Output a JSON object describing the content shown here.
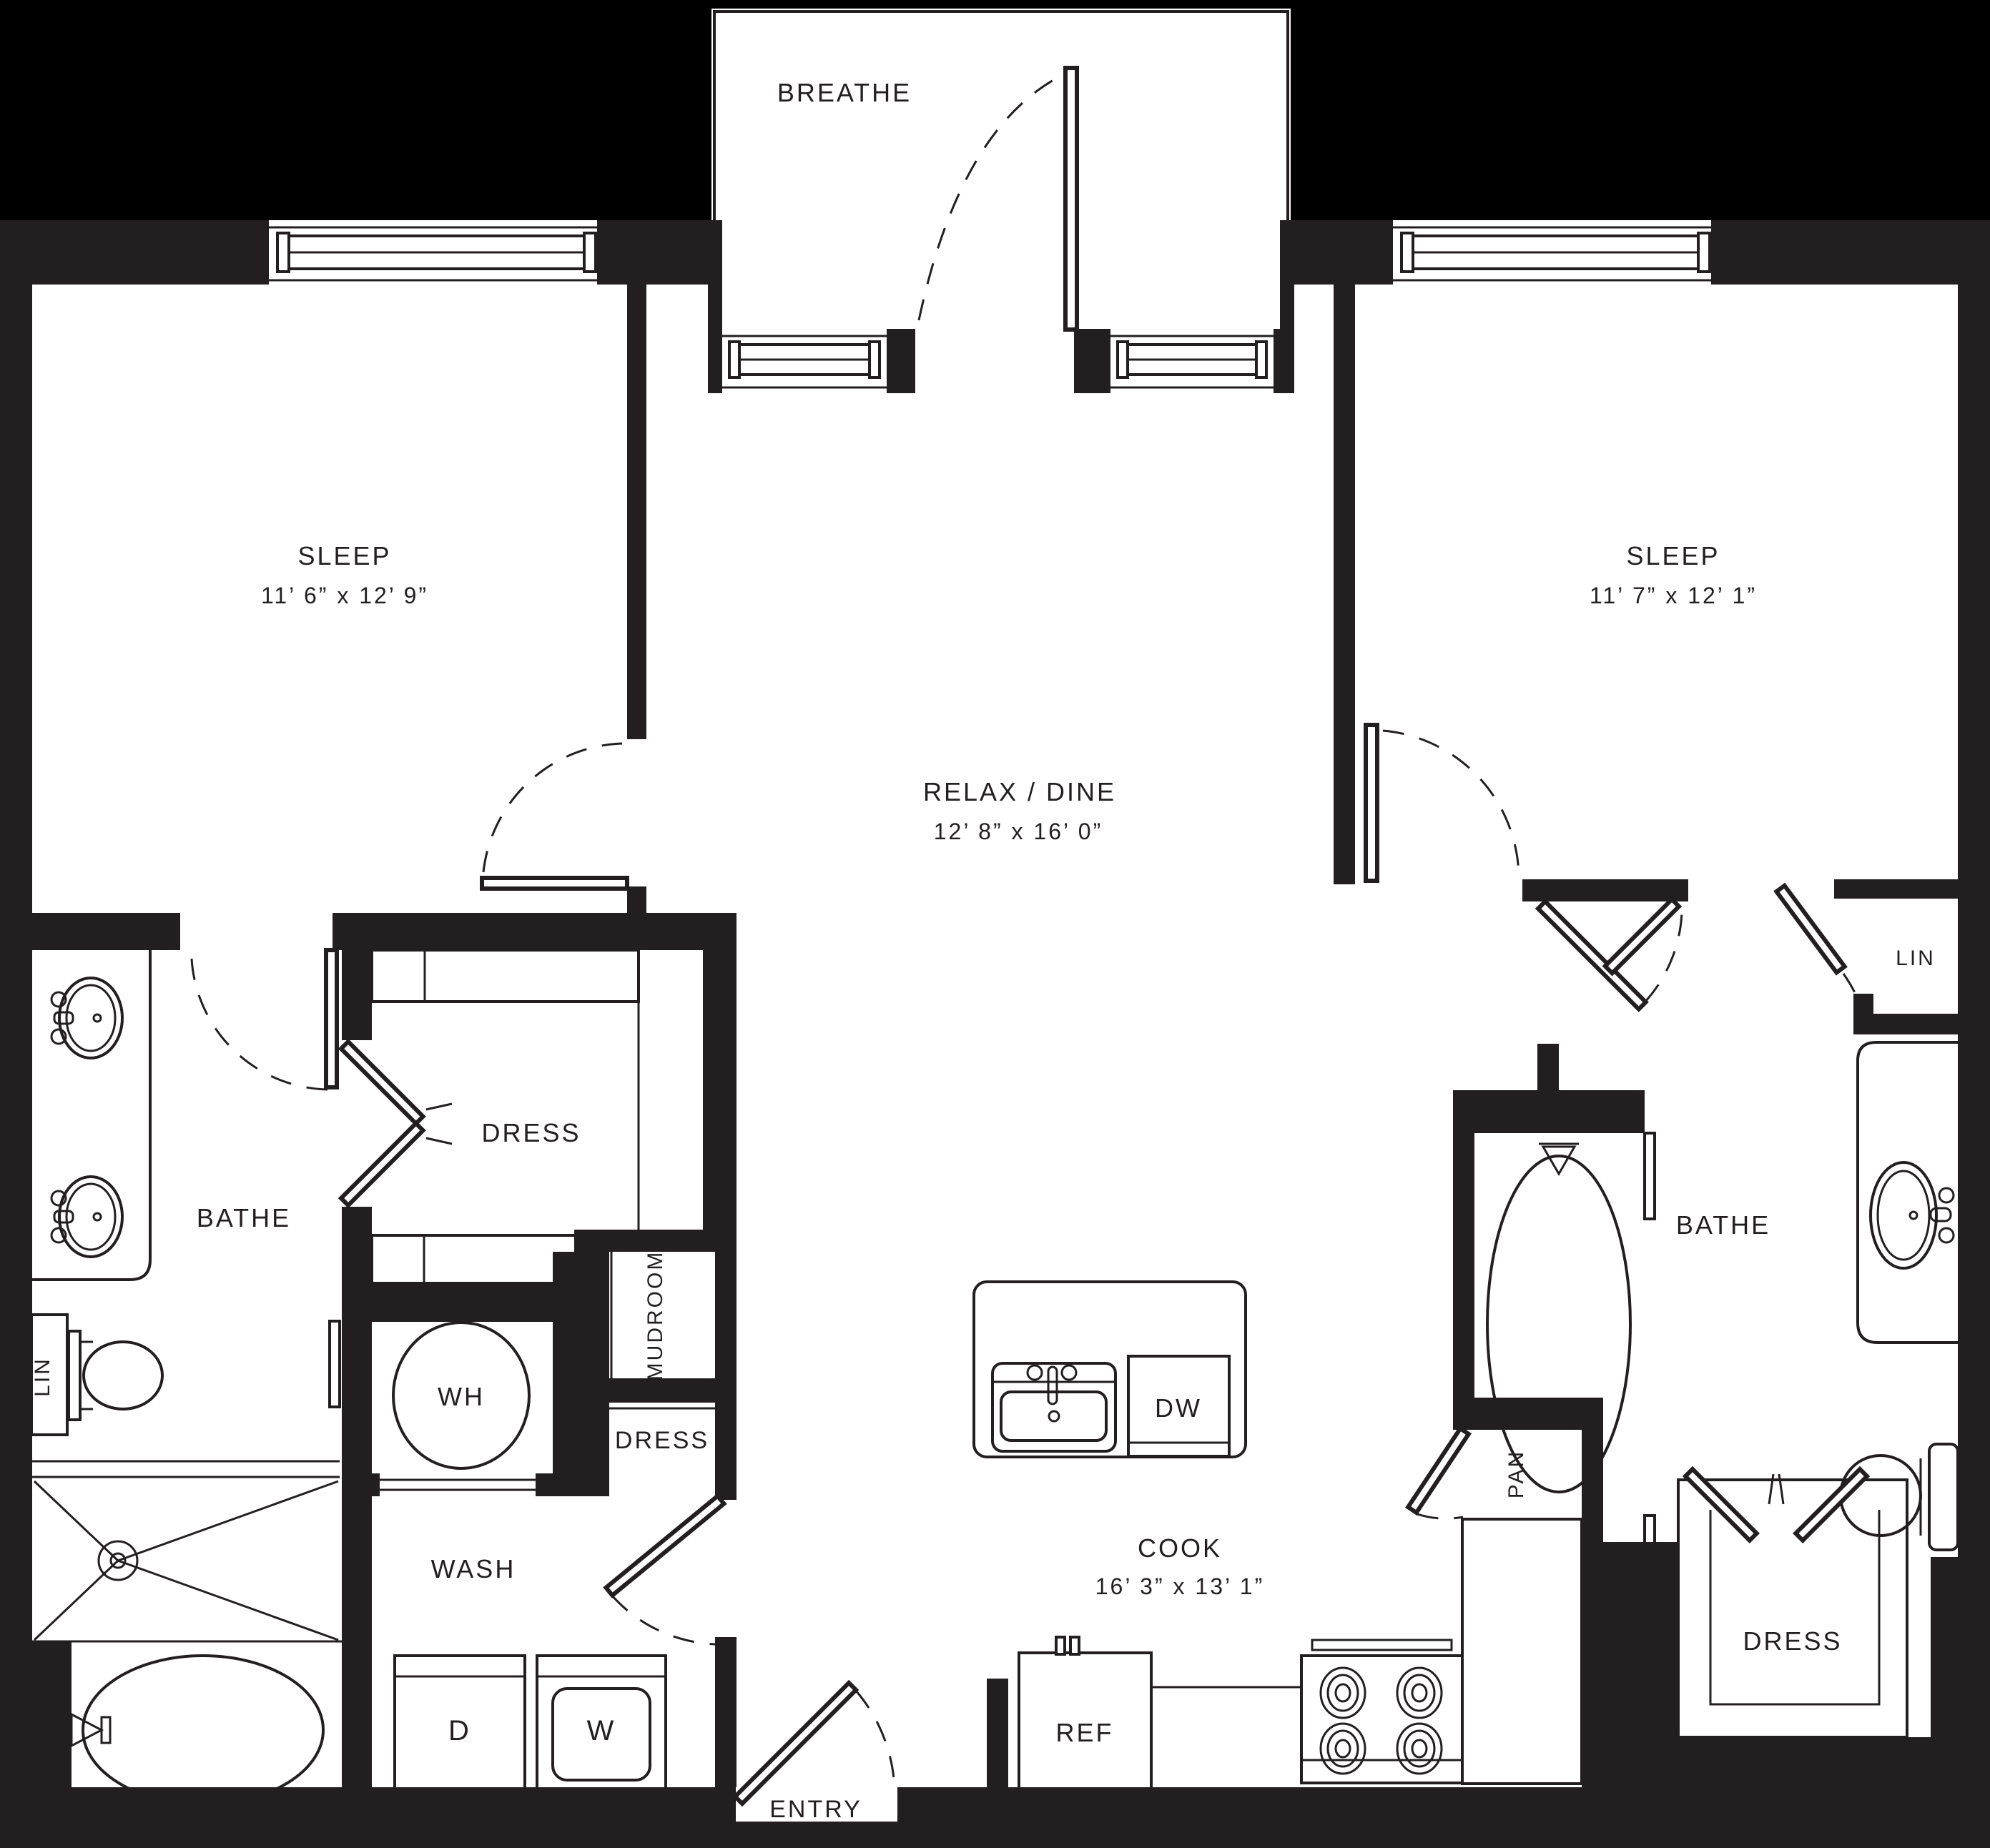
{
  "rooms": {
    "balcony": {
      "name": "BREATHE"
    },
    "sleep_left": {
      "name": "SLEEP",
      "dims": "11’ 6” x 12’ 9”"
    },
    "sleep_right": {
      "name": "SLEEP",
      "dims": "11’ 7” x 12’ 1”"
    },
    "relax_dine": {
      "name": "RELAX / DINE",
      "dims": "12’ 8” x 16’ 0”"
    },
    "cook": {
      "name": "COOK",
      "dims": "16’ 3” x 13’ 1”"
    },
    "bathe_left": {
      "name": "BATHE"
    },
    "bathe_right": {
      "name": "BATHE"
    },
    "dress_left": {
      "name": "DRESS"
    },
    "dress_hall": {
      "name": "DRESS"
    },
    "dress_right": {
      "name": "DRESS"
    },
    "wash": {
      "name": "WASH"
    },
    "mudroom": {
      "name": "MUDROOM"
    },
    "entry": {
      "name": "ENTRY"
    },
    "linen_left": {
      "name": "LIN"
    },
    "linen_right": {
      "name": "LIN"
    },
    "pantry": {
      "name": "PAN"
    }
  },
  "fixtures": {
    "water_heater": "WH",
    "dishwasher": "DW",
    "refrigerator": "REF",
    "dryer": "D",
    "washer": "W"
  },
  "colors": {
    "wall": "#231f20",
    "floor": "#ffffff",
    "background": "#000000"
  }
}
